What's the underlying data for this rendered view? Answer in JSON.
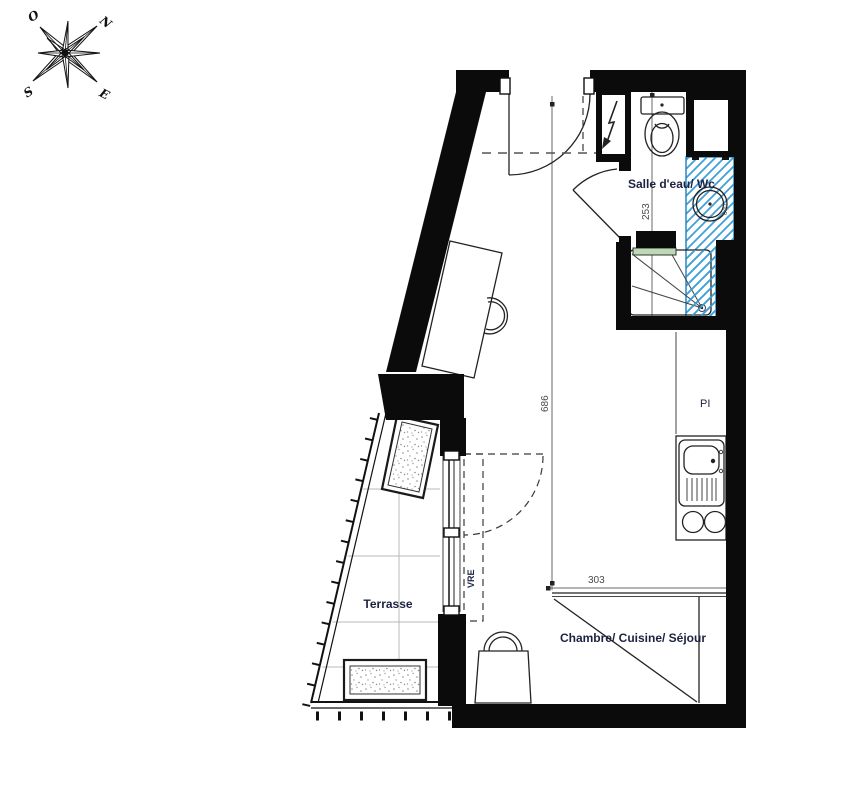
{
  "title": "Studio floor plan",
  "compass": {
    "north": "N",
    "west": "O",
    "south": "S",
    "east": "E"
  },
  "rooms": {
    "bathroom_label": "Salle d'eau/ Wc",
    "terrace_label": "Terrasse",
    "main_room_label": "Chambre/ Cuisine/ Séjour"
  },
  "annotations": {
    "closet": "PI",
    "roller_shutter": "VRE",
    "basin_diameter": "040"
  },
  "dimensions": {
    "bathroom_depth_cm": "253",
    "room_length_cm": "686",
    "room_width_cm": "303"
  },
  "colors": {
    "hatch_blue": "#3f9fd8",
    "hatch_border": "#2b86c0",
    "glass_green": "#bcd9b4",
    "label_ink": "#1c2340",
    "dimension_ink": "#4a4a4a"
  }
}
